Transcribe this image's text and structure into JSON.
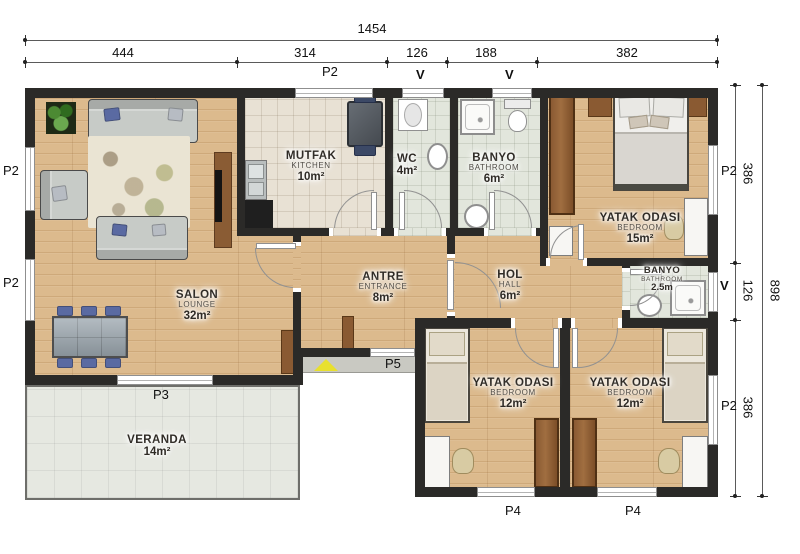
{
  "dimensions": {
    "top_total": "1454",
    "top_segments": [
      "444",
      "314",
      "126",
      "188",
      "382"
    ],
    "right_total": "898",
    "right_segments": [
      "386",
      "126",
      "386"
    ]
  },
  "markers": {
    "top": [
      "P2",
      "V",
      "V"
    ],
    "left": [
      "P2",
      "P2"
    ],
    "right": [
      "P2",
      "V",
      "P2"
    ],
    "bottom": [
      "P4",
      "P4"
    ],
    "salon_window": "P3",
    "entrance_door": "P5"
  },
  "rooms": [
    {
      "id": "salon",
      "name": "SALON",
      "name_en": "LOUNGE",
      "area": "32m²"
    },
    {
      "id": "mutfak",
      "name": "MUTFAK",
      "name_en": "KITCHEN",
      "area": "10m²"
    },
    {
      "id": "wc",
      "name": "WC",
      "name_en": "",
      "area": "4m²"
    },
    {
      "id": "banyo",
      "name": "BANYO",
      "name_en": "BATHROOM",
      "area": "6m²"
    },
    {
      "id": "yatak1",
      "name": "YATAK ODASI",
      "name_en": "BEDROOM",
      "area": "15m²"
    },
    {
      "id": "antre",
      "name": "ANTRE",
      "name_en": "ENTRANCE",
      "area": "8m²"
    },
    {
      "id": "hol",
      "name": "HOL",
      "name_en": "HALL",
      "area": "6m²"
    },
    {
      "id": "banyo2",
      "name": "BANYO",
      "name_en": "BATHROOM",
      "area": "2.5m"
    },
    {
      "id": "yatak2",
      "name": "YATAK ODASI",
      "name_en": "BEDROOM",
      "area": "12m²"
    },
    {
      "id": "yatak3",
      "name": "YATAK ODASI",
      "name_en": "BEDROOM",
      "area": "12m²"
    },
    {
      "id": "veranda",
      "name": "VERANDA",
      "name_en": "",
      "area": "14m²"
    }
  ],
  "colors": {
    "wall": "#2b2a28",
    "wood_floor": "#dcba8d",
    "kitchen_tile": "#e8e1d4",
    "bath_tile": "#e2e6dc",
    "veranda_tile": "#e6e8e1",
    "entrance_triangle": "#e8e02e"
  }
}
